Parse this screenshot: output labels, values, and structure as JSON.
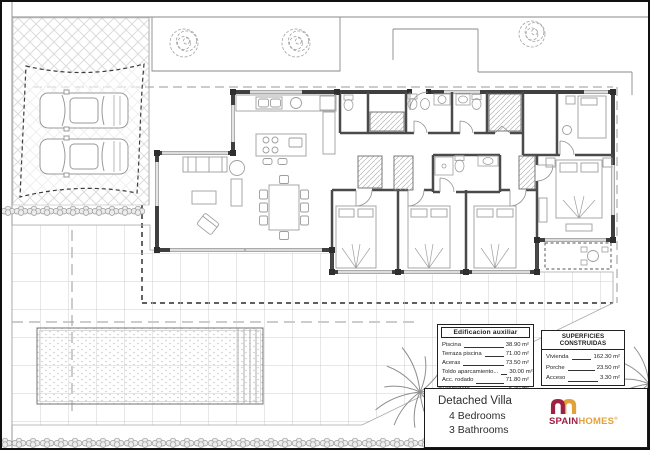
{
  "aux_table": {
    "title": "Edificacion auxiliar",
    "rows": [
      {
        "label": "Piscina",
        "value": "38.90 m²"
      },
      {
        "label": "Terraza piscina",
        "value": "71.00 m²"
      },
      {
        "label": "Aceras",
        "value": "73.50 m²"
      },
      {
        "label": "Toldo aparcamiento...",
        "value": "30.00 m²"
      },
      {
        "label": "Acc. rodado",
        "value": "71.80 m²"
      },
      {
        "label": "Tendedero",
        "value": "5.40 m²"
      }
    ]
  },
  "surfaces_table": {
    "title": "SUPERFICIES CONSTRUIDAS",
    "rows": [
      {
        "label": "Vivienda",
        "value": "162.30 m²"
      },
      {
        "label": "Porche",
        "value": "23.50 m²"
      },
      {
        "label": "Acceso",
        "value": "3.30 m²"
      }
    ],
    "total": {
      "label": "TOTAL",
      "value": "189.10 m²"
    }
  },
  "title_block": {
    "line1": "Detached Villa",
    "line2": "4 Bedrooms",
    "line3": "3 Bathrooms"
  },
  "logo": {
    "word1": "SPAIN",
    "word2": "HOMES",
    "registered": "®"
  },
  "colors": {
    "logo_maroon": "#9e2143",
    "logo_orange": "#e2a23b",
    "wall": "#3f3f3f",
    "furniture": "#9e9e9e"
  }
}
